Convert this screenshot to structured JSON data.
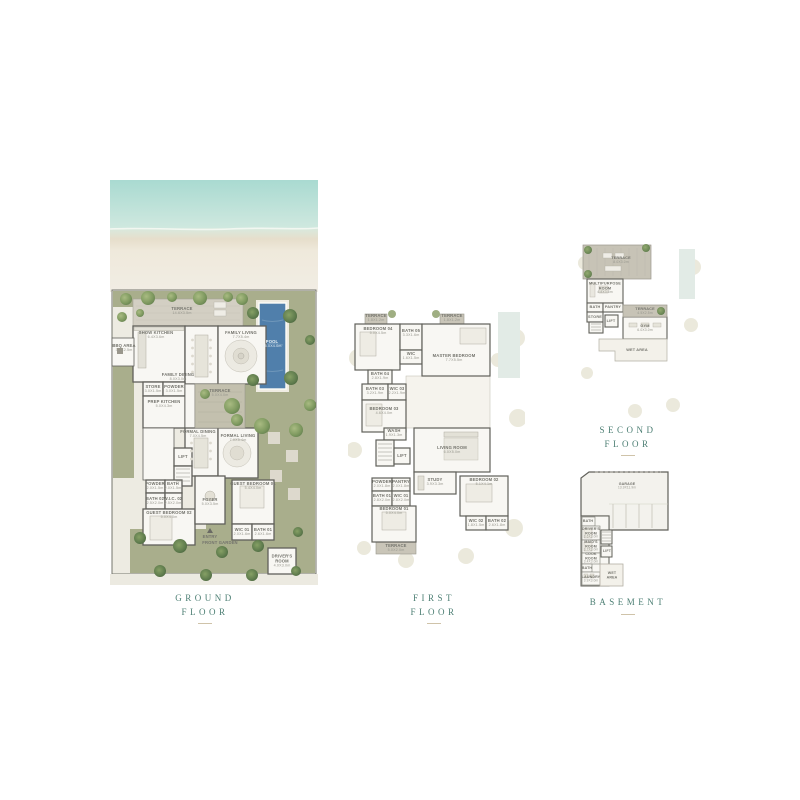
{
  "document": {
    "title": "Villa Floor Plans Sheet"
  },
  "colors": {
    "accent": "#4d7f74",
    "pool": "#507fab",
    "garden": "#a9ae8c",
    "deck": "#cdc9bc",
    "wall": "#60605a",
    "label": "#80807a",
    "rule": "#cfc3a9"
  },
  "captions": {
    "ground": {
      "l1": "GROUND",
      "l2": "FLOOR"
    },
    "first": {
      "l1": "FIRST",
      "l2": "FLOOR"
    },
    "second": {
      "l1": "SECOND",
      "l2": "FLOOR"
    },
    "basement": {
      "l1": "BASEMENT",
      "l2": ""
    }
  },
  "plans": {
    "ground": {
      "labelScale": 0.52,
      "labels": [
        {
          "t": "TERRACE",
          "d": "14.6X3.5m",
          "x": 72,
          "y": 131
        },
        {
          "t": "POOL",
          "d": "15.0X4.0m",
          "x": 162,
          "y": 164,
          "c": "#eaf2f6"
        },
        {
          "t": "SHOW KITCHEN",
          "d": "6.4X3.6m",
          "x": 46,
          "y": 155
        },
        {
          "t": "FAMILY LIVING",
          "d": "7.7X5.4m",
          "x": 131,
          "y": 155
        },
        {
          "t": "FAMILY DINING",
          "d": "8.0X3.0m",
          "x": 68,
          "y": 197
        },
        {
          "t": "BBQ AREA",
          "d": "3.2X2.5m",
          "x": 14,
          "y": 168
        },
        {
          "t": "STORE",
          "d": "3.0X1.5m",
          "x": 43,
          "y": 209
        },
        {
          "t": "POWDER",
          "d": "3.0X1.5m",
          "x": 64,
          "y": 209
        },
        {
          "t": "PREP KITCHEN",
          "d": "5.0X4.3m",
          "x": 54,
          "y": 224
        },
        {
          "t": "TERRACE",
          "d": "5.0X4.0m",
          "x": 110,
          "y": 213
        },
        {
          "t": "FORMAL DINING",
          "d": "7.0X4.5m",
          "x": 88,
          "y": 254
        },
        {
          "t": "FORMAL LIVING",
          "d": "7.0X5.4m",
          "x": 128,
          "y": 258
        },
        {
          "t": "LIFT",
          "x": 73,
          "y": 277
        },
        {
          "t": "POWDER",
          "d": "2.0X1.5m",
          "x": 45,
          "y": 306
        },
        {
          "t": "BATH",
          "d": "2.0X1.5m",
          "x": 63,
          "y": 306
        },
        {
          "t": "BATH 02",
          "d": "2.5X2.0m",
          "x": 45,
          "y": 321
        },
        {
          "t": "W.I.C. 02",
          "d": "2.5X2.0m",
          "x": 63,
          "y": 321
        },
        {
          "t": "GUEST BEDROOM 02",
          "d": "5.0X4.0m",
          "x": 59,
          "y": 335
        },
        {
          "t": "FOYER",
          "d": "5.0X3.5m",
          "x": 100,
          "y": 322
        },
        {
          "t": "ENTRY",
          "x": 100,
          "y": 357
        },
        {
          "t": "GUEST BEDROOM 01",
          "d": "5.4X4.0m",
          "x": 143,
          "y": 306
        },
        {
          "t": "WIC 01",
          "d": "2.0X1.6m",
          "x": 132,
          "y": 352
        },
        {
          "t": "BATH 01",
          "d": "2.6X1.6m",
          "x": 153,
          "y": 352
        },
        {
          "t": "FRONT GARDEN",
          "x": 110,
          "y": 363
        },
        {
          "t": "DRIVER'S",
          "t2": "ROOM",
          "d": "4.0X3.0m",
          "x": 172,
          "y": 381
        }
      ]
    },
    "first": {
      "labelScale": 0.52,
      "labels": [
        {
          "t": "TERRACE",
          "d": "1.8X1.2m",
          "x": 28,
          "y": 18
        },
        {
          "t": "TERRACE",
          "d": "1.8X1.2m",
          "x": 104,
          "y": 18
        },
        {
          "t": "BEDROOM 04",
          "d": "5.0X4.5m",
          "x": 30,
          "y": 31
        },
        {
          "t": "BATH 05",
          "d": "3.3X1.6m",
          "x": 63,
          "y": 33
        },
        {
          "t": "WIC",
          "d": "1.6X1.5m",
          "x": 63,
          "y": 56
        },
        {
          "t": "MASTER BEDROOM",
          "d": "7.7X5.5m",
          "x": 106,
          "y": 58
        },
        {
          "t": "BATH 04",
          "d": "2.8X1.9m",
          "x": 32,
          "y": 76
        },
        {
          "t": "BATH 03",
          "d": "3.2X1.9m",
          "x": 27,
          "y": 91
        },
        {
          "t": "WIC 03",
          "d": "2.2X1.9m",
          "x": 49,
          "y": 91
        },
        {
          "t": "BEDROOM 03",
          "d": "4.6X4.0m",
          "x": 36,
          "y": 111
        },
        {
          "t": "WASH",
          "d": "1.9X1.3m",
          "x": 46,
          "y": 133
        },
        {
          "t": "LIFT",
          "x": 54,
          "y": 156
        },
        {
          "t": "LIVING ROOM",
          "d": "6.0X5.0m",
          "x": 104,
          "y": 150
        },
        {
          "t": "STUDY",
          "d": "3.9X3.3m",
          "x": 87,
          "y": 182
        },
        {
          "t": "POWDER",
          "d": "2.0X1.8m",
          "x": 34,
          "y": 184
        },
        {
          "t": "PANTRY",
          "d": "2.0X1.8m",
          "x": 53,
          "y": 184
        },
        {
          "t": "BATH 01",
          "d": "2.8X2.0m",
          "x": 34,
          "y": 198
        },
        {
          "t": "WIC 01",
          "d": "2.8X2.0m",
          "x": 53,
          "y": 198
        },
        {
          "t": "BEDROOM 01",
          "d": "5.0X4.0m",
          "x": 46,
          "y": 211
        },
        {
          "t": "TERRACE",
          "d": "5.0X2.0m",
          "x": 48,
          "y": 248
        },
        {
          "t": "BEDROOM 02",
          "d": "5.1X4.1m",
          "x": 136,
          "y": 182
        },
        {
          "t": "WIC 02",
          "d": "1.8X1.5m",
          "x": 128,
          "y": 223
        },
        {
          "t": "BATH 02",
          "d": "2.6X1.8m",
          "x": 149,
          "y": 223
        }
      ]
    },
    "second": {
      "labelScale": 0.48,
      "labels": [
        {
          "t": "TERRACE",
          "d": "8.0X3.0m",
          "x": 46,
          "y": 27
        },
        {
          "t": "MULTIPURPOSE",
          "t2": "ROOM",
          "d": "4.8X3.6m",
          "x": 30,
          "y": 55
        },
        {
          "t": "BATH",
          "x": 20,
          "y": 74
        },
        {
          "t": "PANTRY",
          "x": 38,
          "y": 74
        },
        {
          "t": "STORE",
          "x": 20,
          "y": 84
        },
        {
          "t": "LIFT",
          "x": 36,
          "y": 88
        },
        {
          "t": "TERRACE",
          "d": "4.5X2.5m",
          "x": 70,
          "y": 78
        },
        {
          "t": "GYM",
          "d": "6.0X3.0m",
          "x": 70,
          "y": 95
        },
        {
          "t": "WET AREA",
          "x": 62,
          "y": 117
        }
      ]
    },
    "basement": {
      "labelScale": 0.45,
      "labels": [
        {
          "t": "GARAGE",
          "d": "13.9X11.9m",
          "x": 62,
          "y": 28
        },
        {
          "t": "BATH",
          "x": 23,
          "y": 63
        },
        {
          "t": "DRIVER'S",
          "t2": "ROOM",
          "d": "3.6X3.0m",
          "x": 26,
          "y": 75
        },
        {
          "t": "MAID'S",
          "t2": "ROOM",
          "d": "3.7X3.0m",
          "x": 26,
          "y": 88
        },
        {
          "t": "COOK",
          "t2": "ROOM",
          "d": "3.4X3.0m",
          "x": 26,
          "y": 100
        },
        {
          "t": "BATH",
          "x": 22,
          "y": 110
        },
        {
          "t": "LAUNDRY",
          "d": "3.9X3.0m",
          "x": 26,
          "y": 121
        },
        {
          "t": "LIFT",
          "x": 42,
          "y": 93
        },
        {
          "t": "WET",
          "t2": "AREA",
          "x": 47,
          "y": 117
        }
      ]
    }
  }
}
